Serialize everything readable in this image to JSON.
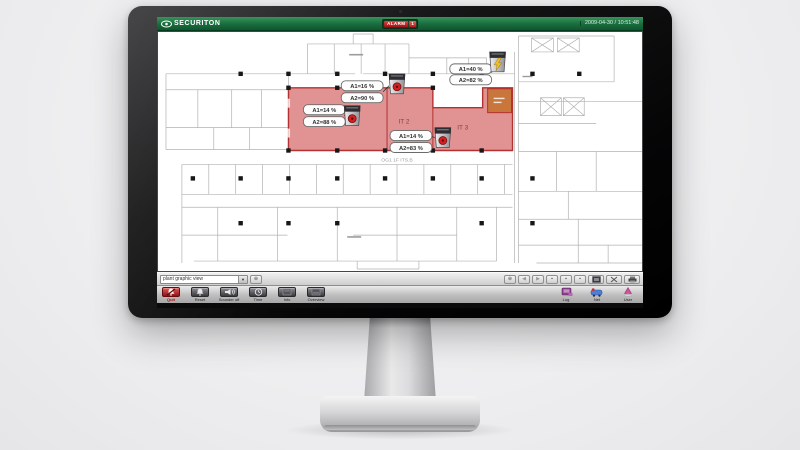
{
  "titlebar": {
    "brand": "SECURITON",
    "alarm_label": "ALARM",
    "alarm_count": "1",
    "datetime": "2009-04-30 / 10:51:48"
  },
  "plan": {
    "floor_label": "OG1 1F ITS.B",
    "rooms": {
      "it2": "IT 2",
      "it3": "IT 3"
    },
    "detectors": [
      {
        "id": "detector-left-room",
        "a1": "A1=14 %",
        "a2": "A2=88 %",
        "state": "alarm"
      },
      {
        "id": "detector-it2",
        "a1": "A1=16 %",
        "a2": "A2=90 %",
        "state": "alarm"
      },
      {
        "id": "detector-it3",
        "a1": "A1=14 %",
        "a2": "A2=83 %",
        "state": "alarm"
      },
      {
        "id": "detector-top-right",
        "a1": "A1=40 %",
        "a2": "A2=82 %",
        "state": "fault"
      }
    ],
    "colors": {
      "alarm_zone": "#cf4f4f",
      "zone_border": "#b23232",
      "fault_box": "#c8763c"
    }
  },
  "viewbar": {
    "view_select_value": "plant graphic view",
    "nav_icons": [
      "zoom-icon",
      "prev-icon",
      "next-icon",
      "tile-icon",
      "tile-icon",
      "tile-icon",
      "fit-screen-icon",
      "scissors-icon",
      "printer-icon"
    ]
  },
  "controlbar": {
    "buttons": [
      {
        "label": "Quit",
        "icon": "bell-slash-icon"
      },
      {
        "label": "Reset",
        "icon": "bell-icon"
      },
      {
        "label": "Sounder off",
        "icon": "horn-icon"
      },
      {
        "label": "Time",
        "icon": "clock-icon"
      },
      {
        "label": "Info",
        "icon": "display-icon"
      },
      {
        "label": "Overview",
        "icon": "display-icon"
      }
    ],
    "right_buttons": [
      {
        "label": "Log",
        "icon": "logbook-icon"
      },
      {
        "label": "Net",
        "icon": "network-icon"
      },
      {
        "label": "User",
        "icon": "user-icon"
      }
    ]
  }
}
